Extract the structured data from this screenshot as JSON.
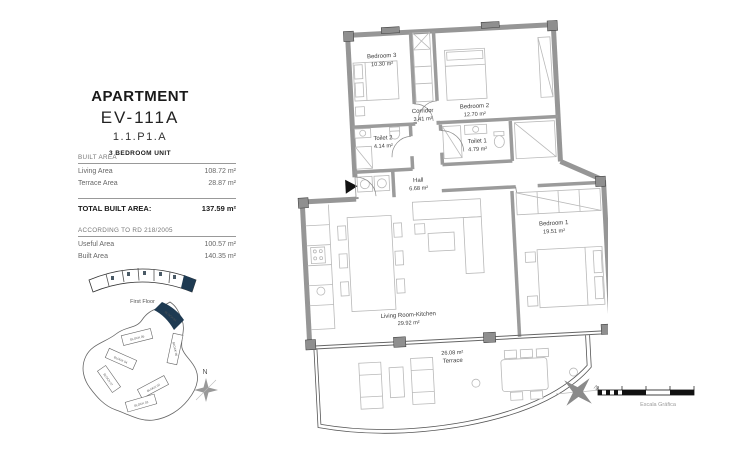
{
  "panel": {
    "title": "APARTMENT",
    "unit_code": "EV-111A",
    "unit_ref": "1.1.P1.A",
    "unit_type": "3 BEDROOM UNIT",
    "built_area": {
      "heading": "BUILT AREA",
      "rows": [
        {
          "label": "Living Area",
          "value": "108.72 m²"
        },
        {
          "label": "Terrace Area",
          "value": "28.87 m²"
        }
      ],
      "total_label": "TOTAL BUILT AREA:",
      "total_value": "137.59 m²"
    },
    "rd": {
      "heading": "ACCORDING TO RD 218/2005",
      "rows": [
        {
          "label": "Useful Area",
          "value": "100.57 m²"
        },
        {
          "label": "Built Area",
          "value": "140.35 m²"
        }
      ]
    },
    "keyplan_floor_label": "First Floor"
  },
  "site": {
    "north_label": "N",
    "blocks": [
      "BLOCK 01",
      "BLOCK 05",
      "BLOCK 06",
      "BLOCK 04",
      "BLOCK 07",
      "BLOCK 02",
      "BLOCK 03"
    ]
  },
  "plan": {
    "rooms": [
      {
        "name": "Bedroom 3",
        "area": "10.30 m²"
      },
      {
        "name": "Corridor",
        "area": "3.41 m²"
      },
      {
        "name": "Bedroom 2",
        "area": "12.70 m²"
      },
      {
        "name": "Toilet 2",
        "area": "4.14 m²"
      },
      {
        "name": "Toilet 1",
        "area": "4.79 m²"
      },
      {
        "name": "Hall",
        "area": "6.68 m²"
      },
      {
        "name": "Bedroom 1",
        "area": "19.51 m²"
      },
      {
        "name": "Living Room-Kitchen",
        "area": "29.92 m²"
      }
    ],
    "terrace": {
      "area": "26.08 m²",
      "name": "Terrace"
    }
  },
  "scalebar": {
    "label": "Escala Gráfica",
    "north_label": "N"
  },
  "colors": {
    "highlight": "#1e3a52",
    "wall": "#969696",
    "furniture": "#b9b9b9"
  }
}
